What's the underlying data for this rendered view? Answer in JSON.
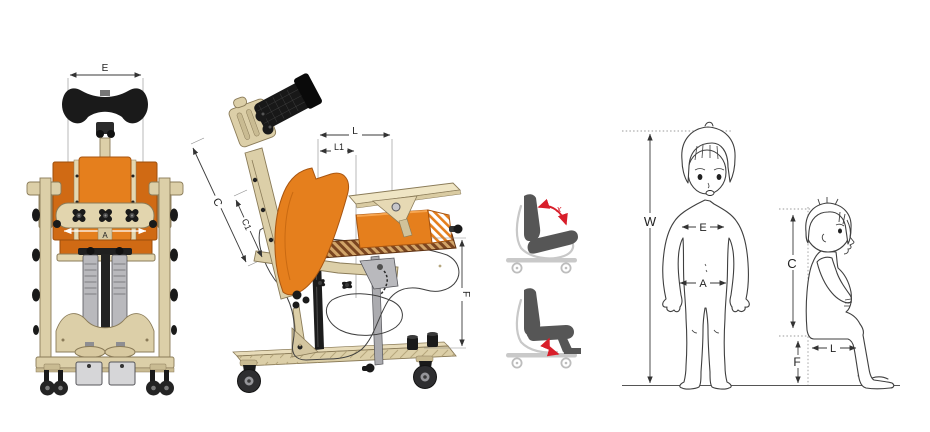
{
  "diagram_title": "standing-frame dimensions diagram",
  "colors": {
    "cushion_orange": "#E57F1D",
    "wood_beige": "#DCCFA8",
    "accent_red": "#D81E2A",
    "metal_gray": "#B9B9BD",
    "pictogram_gray": "#565656",
    "line_color": "#3A3A3A"
  },
  "stander_front_view": {
    "dim_headrest_width": "E",
    "dim_hip_width": "A"
  },
  "stander_side_view": {
    "dim_back_height": "C",
    "dim_back_height_inner": "C1",
    "dim_seat_depth": "L",
    "dim_seat_depth_inner": "L1",
    "dim_footplate_height": "F"
  },
  "pictograms": {
    "backrest_recline": {
      "angle_label": "x"
    }
  },
  "children": {
    "standing": {
      "dim_height": "W",
      "dim_chest_width": "E",
      "dim_hip_width": "A"
    },
    "sitting": {
      "dim_back_height": "C",
      "dim_thigh_length": "L",
      "dim_leg_height": "F"
    }
  }
}
